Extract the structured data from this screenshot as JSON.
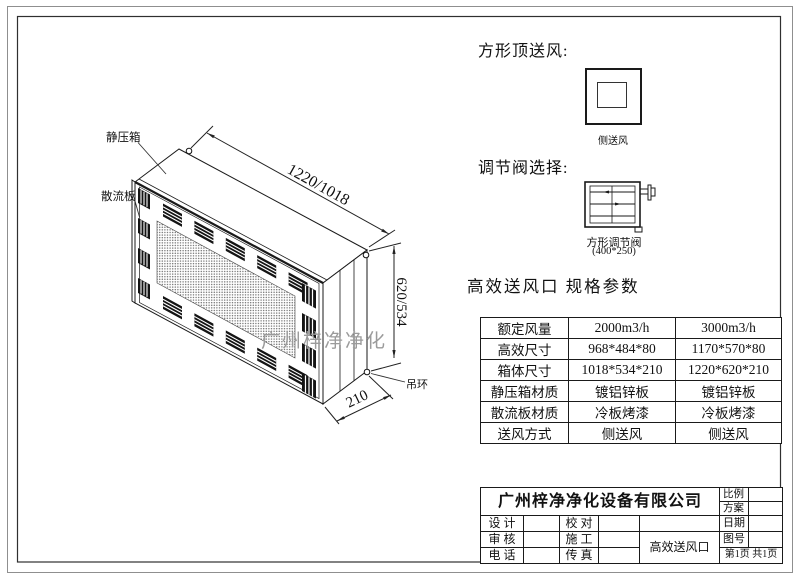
{
  "drawing": {
    "labels": {
      "plenum": "静压箱",
      "diffuser": "散流板",
      "ring": "吊环"
    },
    "dims": {
      "length": "1220/1018",
      "height": "620/534",
      "depth": "210"
    },
    "watermark": "广州梓净净化"
  },
  "top_supply": {
    "heading": "方形顶送风:",
    "caption": "侧送风"
  },
  "valve": {
    "heading": "调节阀选择:",
    "caption_name": "方形调节阀",
    "caption_size": "(400*250)"
  },
  "specs": {
    "heading": "高效送风口 规格参数",
    "rows": [
      {
        "label": "额定风量",
        "v1": "2000m3/h",
        "v2": "3000m3/h"
      },
      {
        "label": "高效尺寸",
        "v1": "968*484*80",
        "v2": "1170*570*80"
      },
      {
        "label": "箱体尺寸",
        "v1": "1018*534*210",
        "v2": "1220*620*210"
      },
      {
        "label": "静压箱材质",
        "v1": "镀铝锌板",
        "v2": "镀铝锌板"
      },
      {
        "label": "散流板材质",
        "v1": "冷板烤漆",
        "v2": "冷板烤漆"
      },
      {
        "label": "送风方式",
        "v1": "侧送风",
        "v2": "侧送风"
      }
    ]
  },
  "titleblock": {
    "company": "广州梓净净化设备有限公司",
    "design": "设 计",
    "check": "校 对",
    "audit": "审 核",
    "construct": "施 工",
    "phone": "电 话",
    "fax": "传 真",
    "product": "高效送风口",
    "scale": "比例",
    "plan": "方案",
    "date": "日期",
    "drawing_no": "图号",
    "page": "第1页 共1页"
  },
  "colors": {
    "line": "#1a1a1a",
    "border_outer": "#8f8f8f",
    "watermark": "#9b9b9b"
  }
}
